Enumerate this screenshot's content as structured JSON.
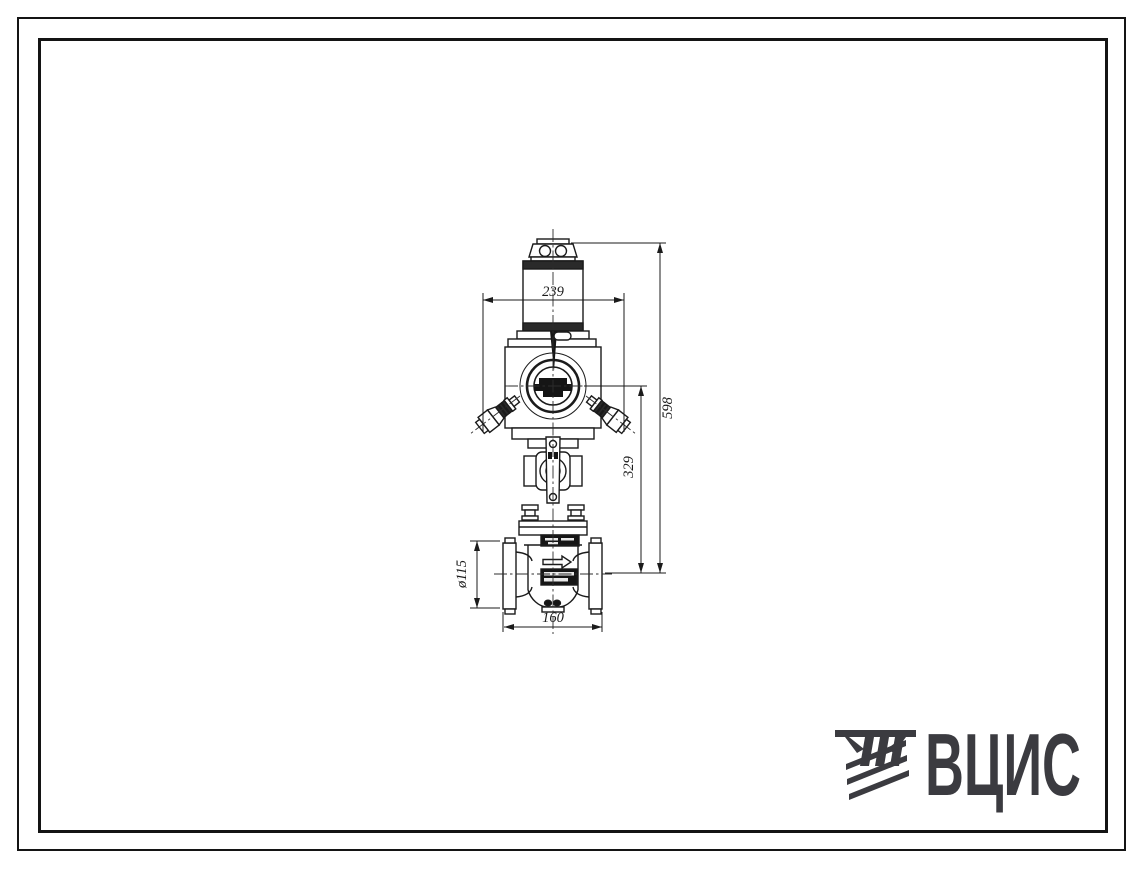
{
  "page": {
    "background": "#ffffff",
    "ink_color": "#1b1b1b"
  },
  "drawing": {
    "kind": "valve-with-electric-actuator-front-view",
    "dimensions": {
      "top_width": "239",
      "overall_height": "598",
      "mid_height": "329",
      "bottom_width": "160",
      "flange_diameter": "ø115"
    }
  },
  "logo": {
    "text": "ВЦИС",
    "color": "#3b3b40"
  }
}
